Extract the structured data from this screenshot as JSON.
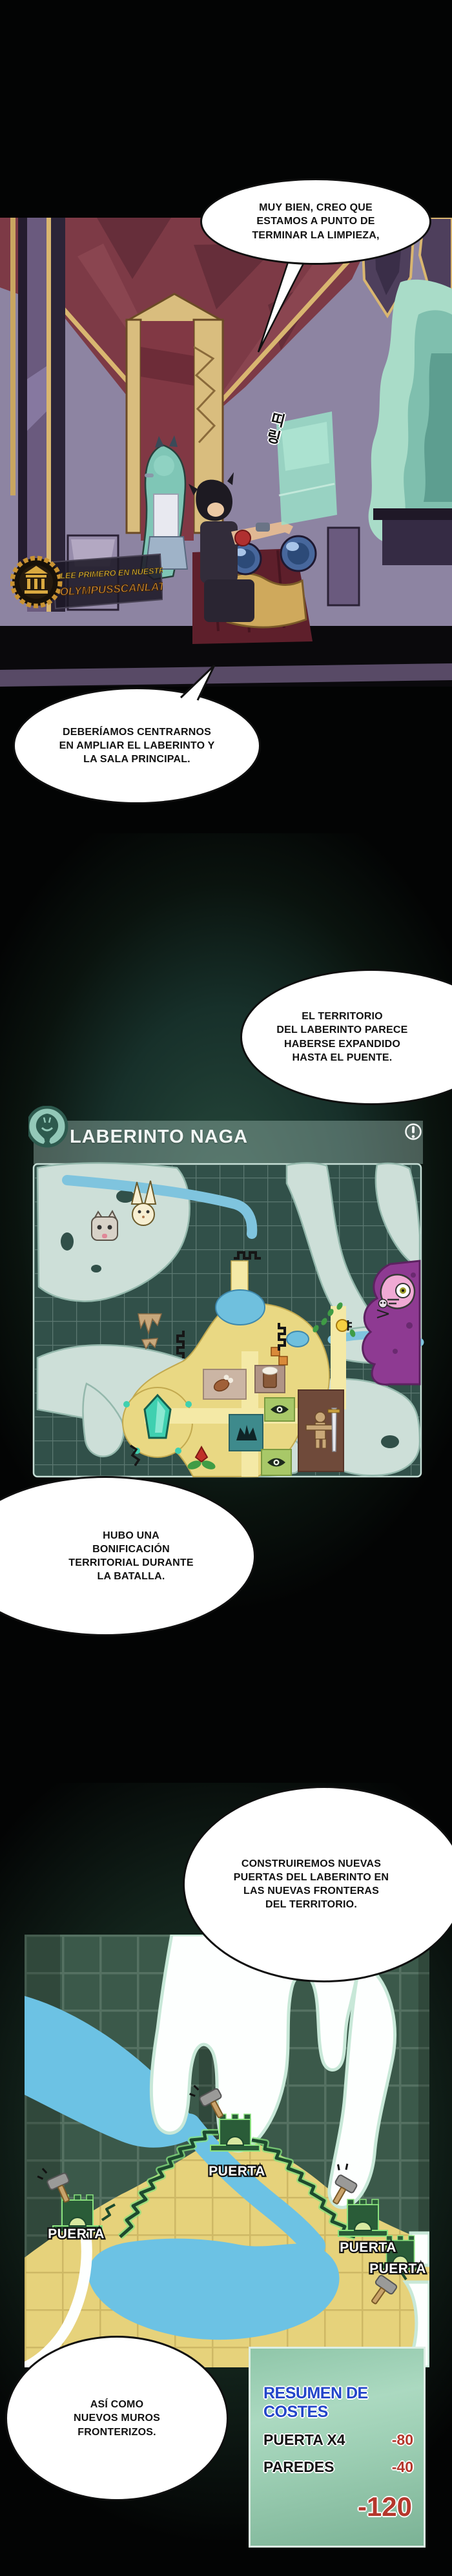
{
  "watermark": {
    "line1": "LEE PRIMERO EN NUESTRA WEB",
    "line2": "OLYMPUSSCANLATION.COM",
    "logo": "olympus-temple-logo"
  },
  "scene": {
    "sfx": "띠링"
  },
  "bubbles": [
    {
      "text": "MUY BIEN, CREO QUE\nESTAMOS A PUNTO DE\nTERMINAR LA LIMPIEZA,"
    },
    {
      "text": "DEBERÍAMOS CENTRARNOS\nEN AMPLIAR EL LABERINTO Y\nLA SALA PRINCIPAL."
    },
    {
      "text": "EL TERRITORIO\nDEL LABERINTO PARECE\nHABERSE EXPANDIDO\nHASTA EL PUENTE."
    },
    {
      "text": "HUBO UNA\nBONIFICACIÓN\nTERRITORIAL DURANTE\nLA BATALLA."
    },
    {
      "text": "CONSTRUIREMOS NUEVAS\nPUERTAS DEL LABERINTO EN\nLAS NUEVAS FRONTERAS\nDEL TERRITORIO."
    },
    {
      "text": "ASÍ COMO\nNUEVOS MUROS\nFRONTERIZOS."
    }
  ],
  "map1": {
    "title": "LABERINTO NAGA",
    "header_icon": "naga-snake-icon",
    "info_icon": "alert-info-icon"
  },
  "map2": {
    "gates": [
      {
        "label": "PUERTA"
      },
      {
        "label": "PUERTA"
      },
      {
        "label": "PUERTA"
      },
      {
        "label": "PUERTA"
      }
    ]
  },
  "cost_panel": {
    "title": "RESUMEN DE COSTES",
    "rows": [
      {
        "label": "PUERTA X4",
        "value": "-80"
      },
      {
        "label": "PAREDES",
        "value": "-40"
      }
    ],
    "total": "-120"
  },
  "colors": {
    "cost_title_blue": "#2346c9",
    "cost_negative_red": "#b5372c",
    "map_panel_green": "#315049",
    "territory_yellow": "#e6d27b",
    "river_blue": "#6cc2e4",
    "gate_green": "#2a5c38"
  }
}
